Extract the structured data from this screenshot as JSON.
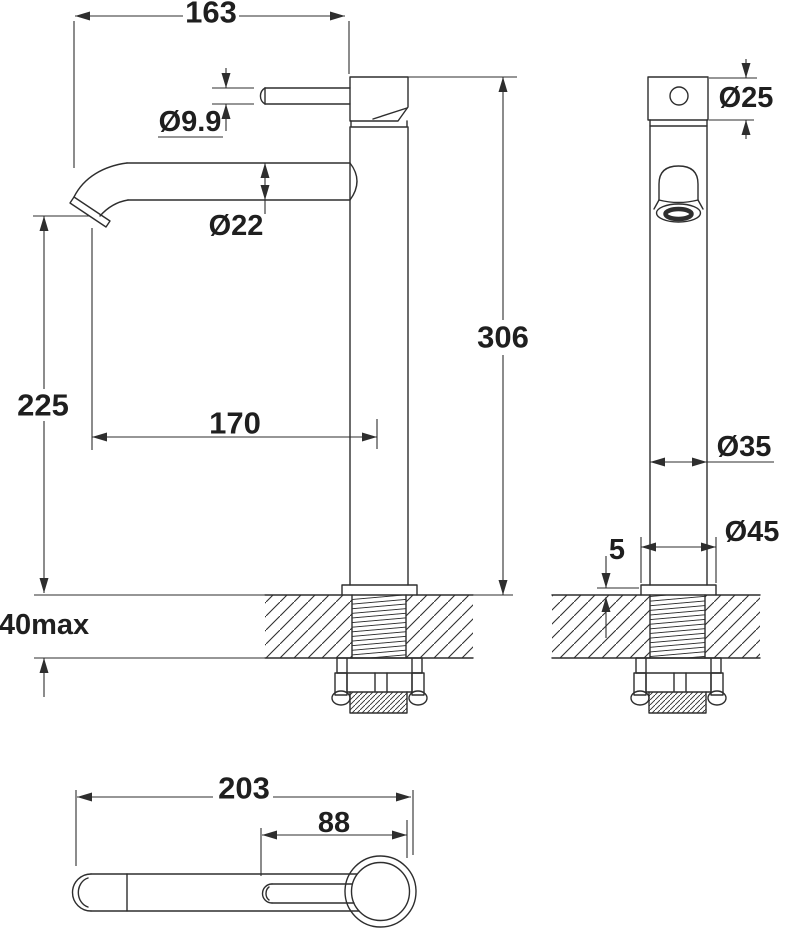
{
  "page": {
    "background": "#ffffff",
    "line_color": "#2e2e2e",
    "text_color": "#1f1f1f",
    "content": "faucet-technical-drawing-three-views"
  },
  "dimensions": {
    "front": {
      "spout_reach": "163",
      "handle_diameter": "Ø9.9",
      "spout_tube_diameter": "Ø22",
      "spout_outlet_height": "225",
      "outlet_to_body_axis": "170",
      "deck_thickness_max": "40max",
      "overall_height": "306"
    },
    "side": {
      "handle_diameter": "Ø25",
      "body_diameter": "Ø35",
      "base_diameter": "Ø45",
      "base_plate_height": "5"
    },
    "plan": {
      "overall_length": "203",
      "handle_length": "88"
    }
  }
}
